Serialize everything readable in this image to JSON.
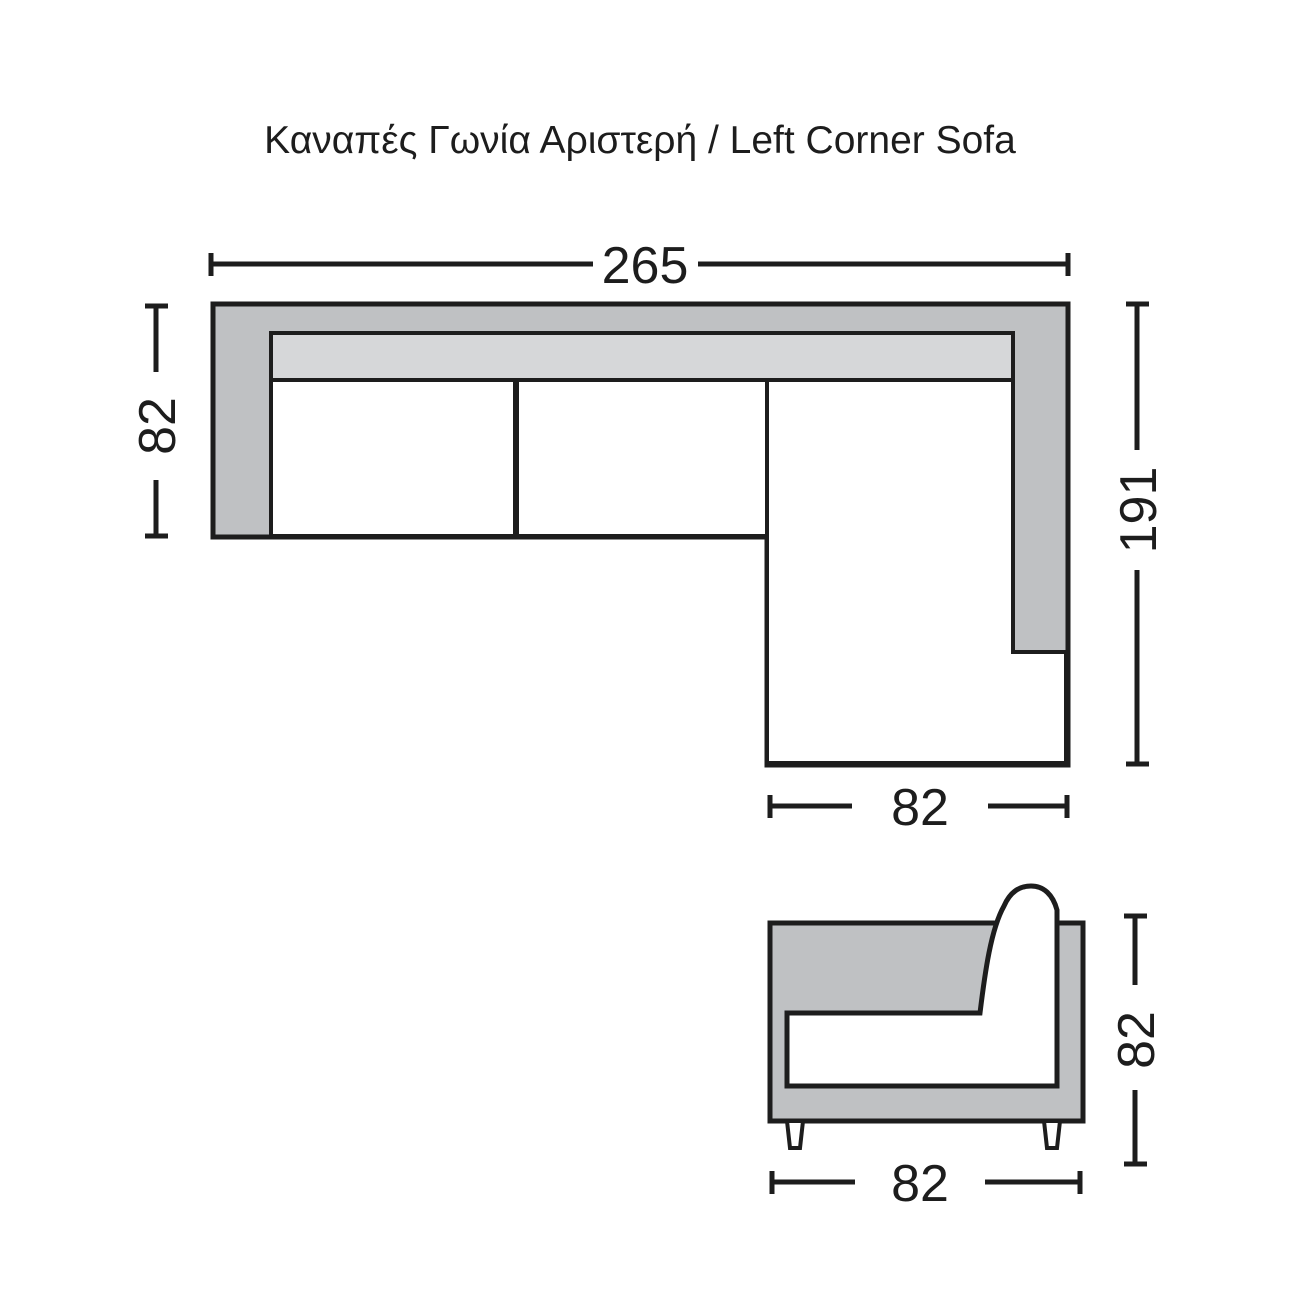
{
  "title": "Καναπές Γωνία Αριστερή / Left Corner Sofa",
  "top_view": {
    "overall_width": "265",
    "side_depth": "82",
    "chaise_length": "191",
    "chaise_width": "82"
  },
  "front_view": {
    "height": "82",
    "width": "82"
  },
  "colors": {
    "line": "#1d1d1d",
    "frame_gray": "#bfc1c3",
    "cushion_gray": "#d6d7d9",
    "background": "#ffffff"
  }
}
